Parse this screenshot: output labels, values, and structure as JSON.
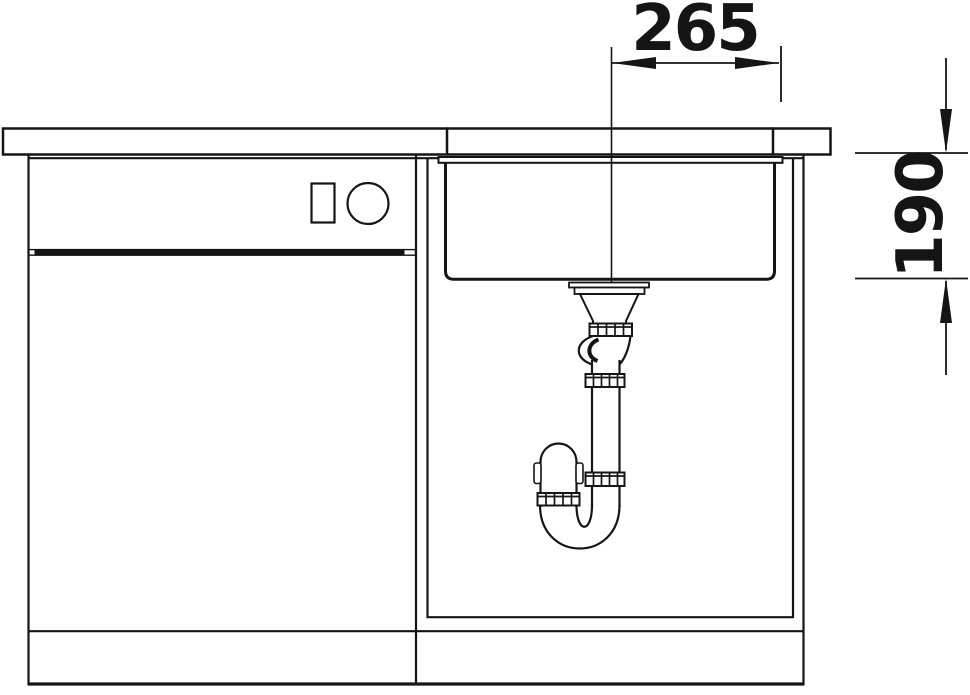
{
  "drawing": {
    "background_color": "#ffffff",
    "line_color": "#151515",
    "dimensions": {
      "width_label": "265",
      "depth_label": "190"
    }
  }
}
